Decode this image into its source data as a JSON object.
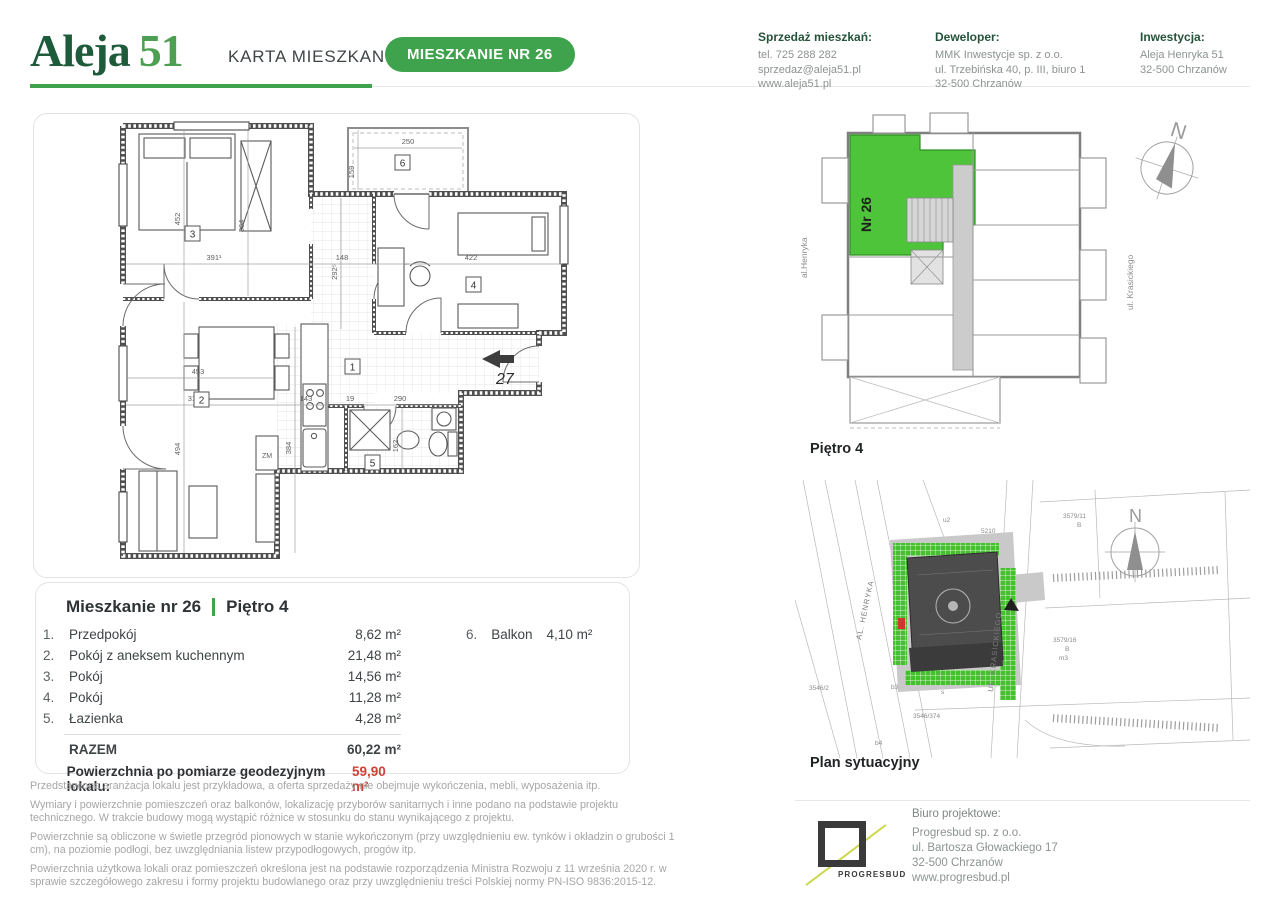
{
  "header": {
    "logo_part1": "Aleja",
    "logo_part2": "51",
    "doc_title": "KARTA MIESZKANIA",
    "badge": "MIESZKANIE NR 26",
    "contacts": [
      {
        "title": "Sprzedaż mieszkań:",
        "lines": [
          "tel. 725 288 282",
          "sprzedaz@aleja51.pl",
          "www.aleja51.pl"
        ]
      },
      {
        "title": "Deweloper:",
        "lines": [
          "MMK Inwestycje sp. z o.o.",
          "ul. Trzebińska 40, p. III, biuro 1",
          "32-500 Chrzanów"
        ]
      },
      {
        "title": "Inwestycja:",
        "lines": [
          "Aleja Henryka 51",
          "32-500 Chrzanów"
        ]
      }
    ]
  },
  "floor_plan": {
    "rooms": [
      "1",
      "2",
      "3",
      "4",
      "5",
      "6"
    ],
    "dims": [
      "250",
      "159",
      "391¹",
      "148",
      "422",
      "452",
      "364",
      "292⁵",
      "453",
      "310",
      "143",
      "19",
      "290",
      "162",
      "494",
      "384"
    ],
    "entry_label": "27",
    "zm_label": "ZM"
  },
  "building_plan": {
    "unit_label": "Nr 26",
    "floor_label": "Piętro 4",
    "street_left": "al.Henryka",
    "street_right": "ul. Krasickiego",
    "compass": "N"
  },
  "site_plan": {
    "title": "Plan sytuacyjny",
    "street_1": "AL. HENRYKA",
    "street_2": "UL. KRASICKIEGO",
    "compass": "N",
    "parcels": [
      "5210",
      "u2",
      "3579/11",
      "B",
      "3579/16",
      "B",
      "m3",
      "3546/374",
      "3546/2",
      "b3",
      "b4",
      "s"
    ]
  },
  "unit_table": {
    "title": "Mieszkanie nr 26",
    "floor": "Piętro 4",
    "rows": [
      {
        "no": "1.",
        "name": "Przedpokój",
        "area": "8,62 m²"
      },
      {
        "no": "2.",
        "name": "Pokój z aneksem kuchennym",
        "area": "21,48 m²"
      },
      {
        "no": "3.",
        "name": "Pokój",
        "area": "14,56 m²"
      },
      {
        "no": "4.",
        "name": "Pokój",
        "area": "11,28 m²"
      },
      {
        "no": "5.",
        "name": "Łazienka",
        "area": "4,28 m²"
      }
    ],
    "total_label": "RAZEM",
    "total_area": "60,22 m²",
    "geo_label": "Powierzchnia po pomiarze geodezyjnym lokalu:",
    "geo_value": "59,90 m²",
    "balcony": {
      "no": "6.",
      "name": "Balkon",
      "area": "4,10 m²"
    }
  },
  "disclaimers": [
    "Przedstawiona aranżacja lokalu jest przykładowa, a oferta sprzedaży nie obejmuje wykończenia, mebli, wyposażenia itp.",
    "Wymiary i powierzchnie pomieszczeń oraz balkonów, lokalizację przyborów sanitarnych i inne podano na podstawie projektu technicznego. W trakcie budowy mogą wystąpić różnice w stosunku do stanu wynikającego z projektu.",
    "Powierzchnie są obliczone w świetle przegród pionowych w stanie wykończonym (przy uwzględnieniu ew. tynków i okładzin o grubości 1 cm), na poziomie podłogi, bez uwzględniania listew przypodłogowych, progów itp.",
    "Powierzchnia użytkowa lokali oraz pomieszczeń określona jest na podstawie rozporządzenia Ministra Rozwoju z 11 września 2020 r. w sprawie szczegółowego zakresu i formy projektu budowlanego oraz przy uwzględnieniu treści Polskiej normy PN-ISO 9836:2015-12."
  ],
  "design_office": {
    "logo_text": "PROGRESBUD",
    "title": "Biuro projektowe:",
    "lines": [
      "Progresbud sp. z o.o.",
      "ul. Bartosza Głowackiego 17",
      "32-500 Chrzanów",
      "www.progresbud.pl"
    ]
  }
}
